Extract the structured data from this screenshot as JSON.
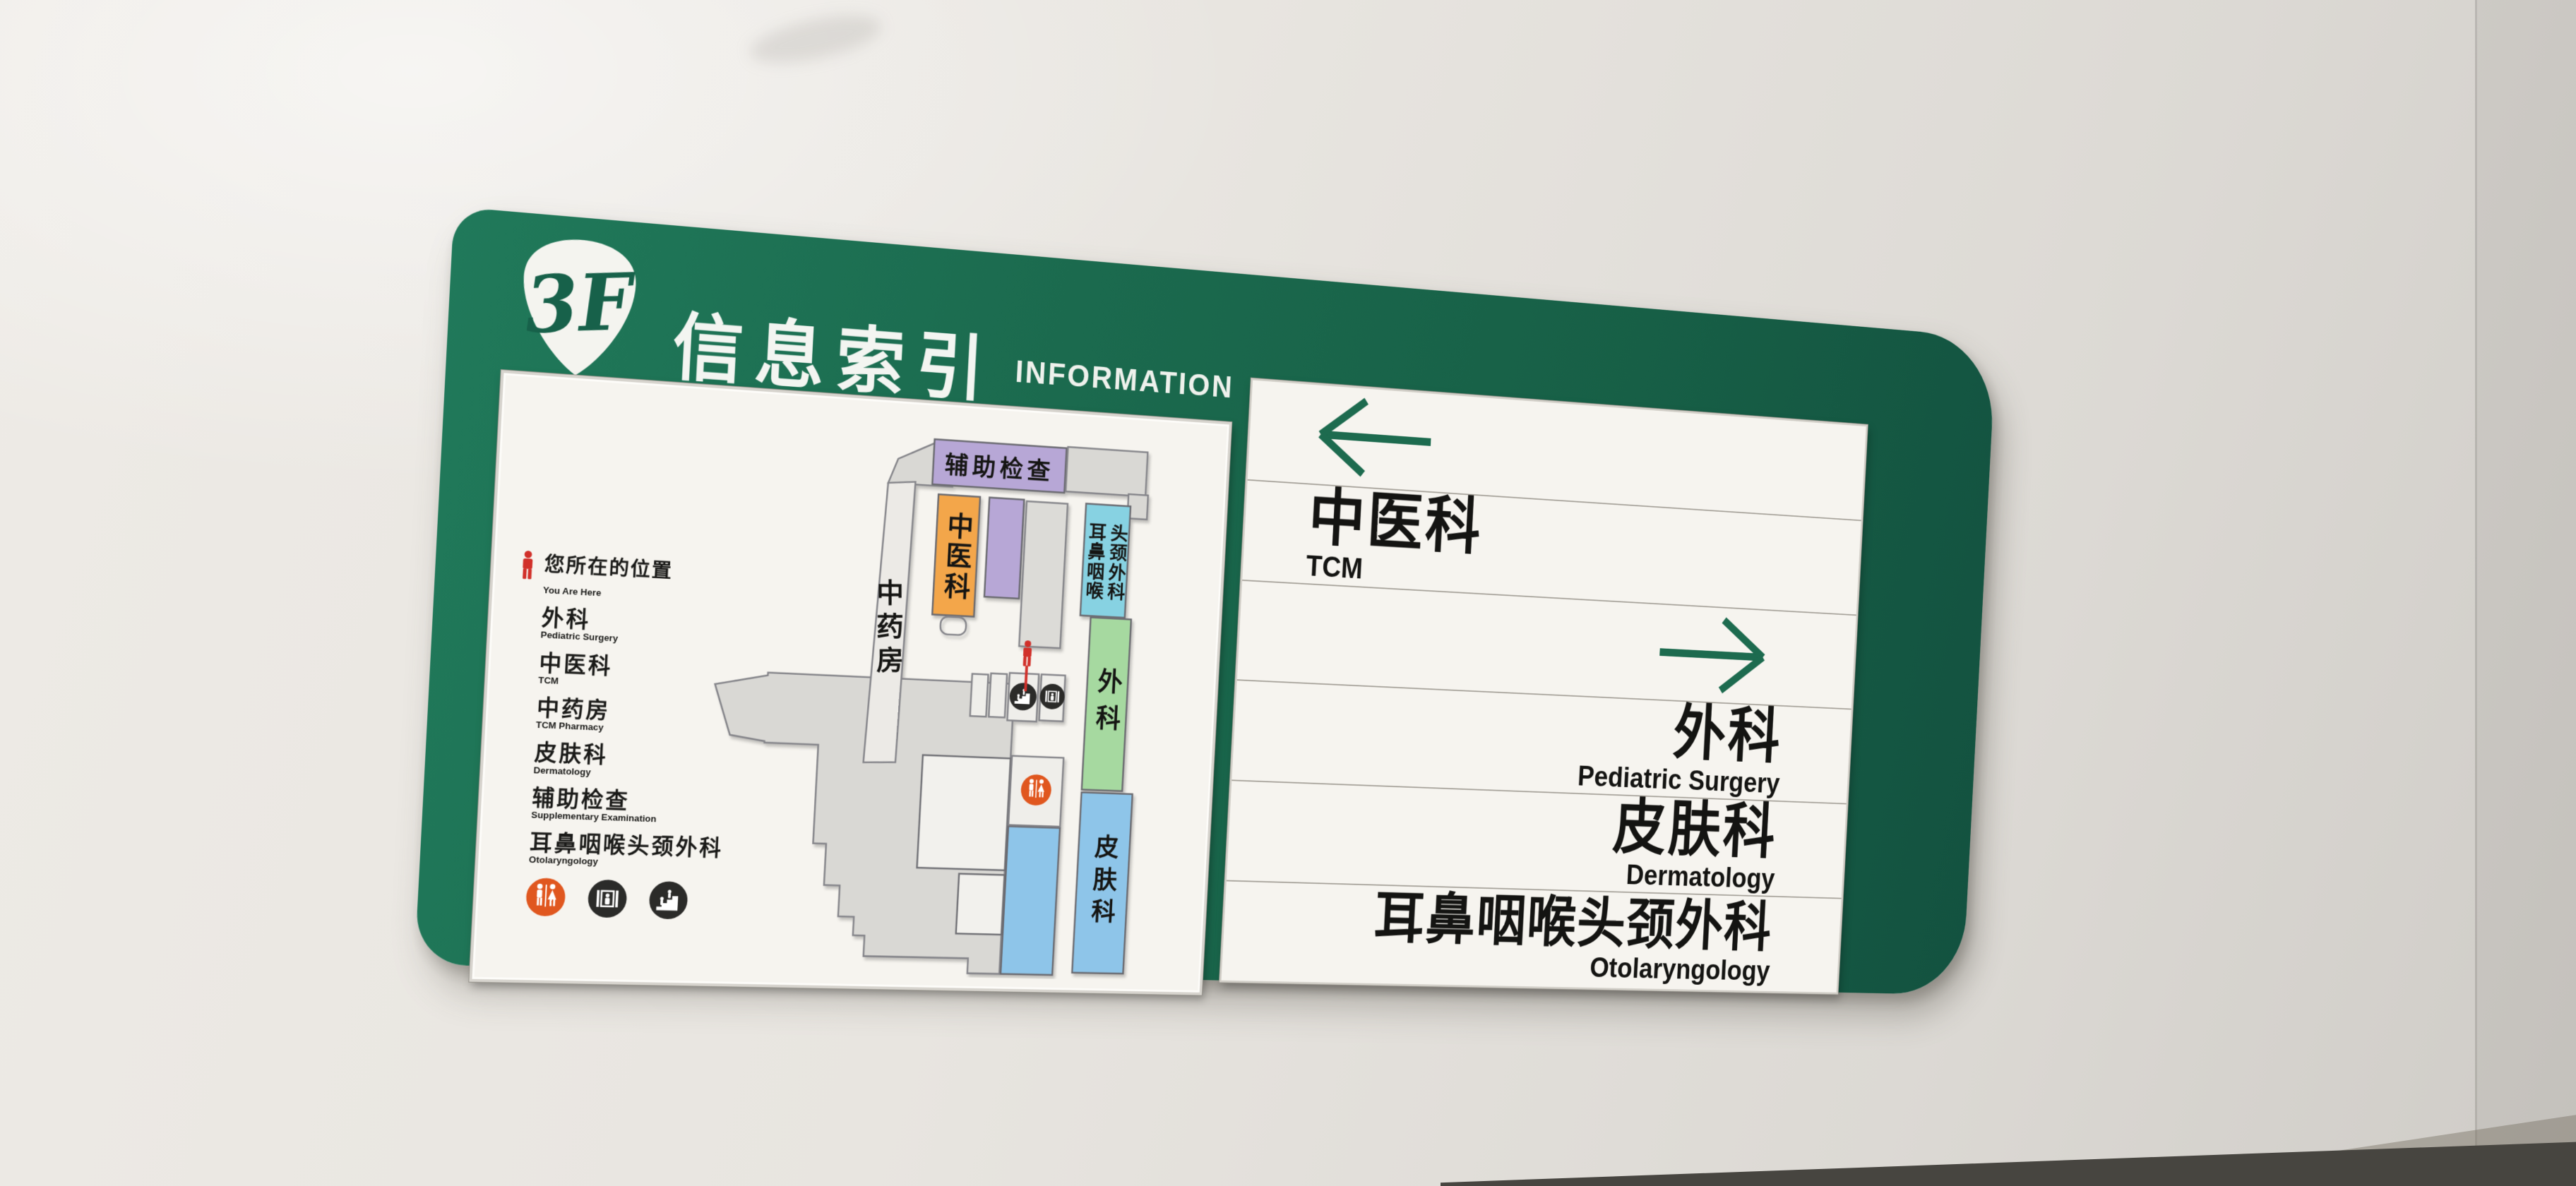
{
  "header": {
    "floor_badge": "3F",
    "title_zh": "信息索引",
    "title_en": "INFORMATION"
  },
  "map_panel": {
    "legend": {
      "marker_zh": "您所在的位置",
      "marker_en": "You Are Here",
      "entries": [
        {
          "zh": "外科",
          "en": "Pediatric Surgery"
        },
        {
          "zh": "中医科",
          "en": "TCM"
        },
        {
          "zh": "中药房",
          "en": "TCM Pharmacy"
        },
        {
          "zh": "皮肤科",
          "en": "Dermatology"
        },
        {
          "zh": "辅助检查",
          "en": "Supplementary Examination"
        },
        {
          "zh": "耳鼻咽喉头颈外科",
          "en": "Otolaryngology"
        }
      ]
    },
    "areas": {
      "aux": "辅助检查",
      "pharmacy": "中药房",
      "tcm": "中医科",
      "ent_left": "耳鼻咽喉",
      "ent_right": "头颈外科",
      "surgery": "外科",
      "derm": "皮肤科"
    },
    "icons": [
      "toilet",
      "elevator",
      "stairs"
    ]
  },
  "directory": {
    "rows": [
      {
        "type": "arrow",
        "direction": "left"
      },
      {
        "type": "dept",
        "zh": "中医科",
        "en": "TCM",
        "align": "left"
      },
      {
        "type": "arrow",
        "direction": "right"
      },
      {
        "type": "dept",
        "zh": "外科",
        "en": "Pediatric Surgery",
        "align": "right"
      },
      {
        "type": "dept",
        "zh": "皮肤科",
        "en": "Dermatology",
        "align": "right"
      },
      {
        "type": "dept",
        "zh": "耳鼻咽喉头颈外科",
        "en": "Otolaryngology",
        "align": "right"
      }
    ]
  },
  "colors": {
    "board_green": "#1b6a4e",
    "arrow_green": "#1d6b4f",
    "panel_white": "#f6f4ef",
    "aux_purple": "#b7a7d6",
    "tcm_orange": "#f3a64a",
    "ent_cyan": "#87d2e2",
    "surgery_green": "#a6d9a0",
    "derm_blue": "#8ec5e9",
    "marker_red": "#d1302a",
    "toilet_orange": "#e0571f",
    "icon_black": "#2b2b29"
  }
}
